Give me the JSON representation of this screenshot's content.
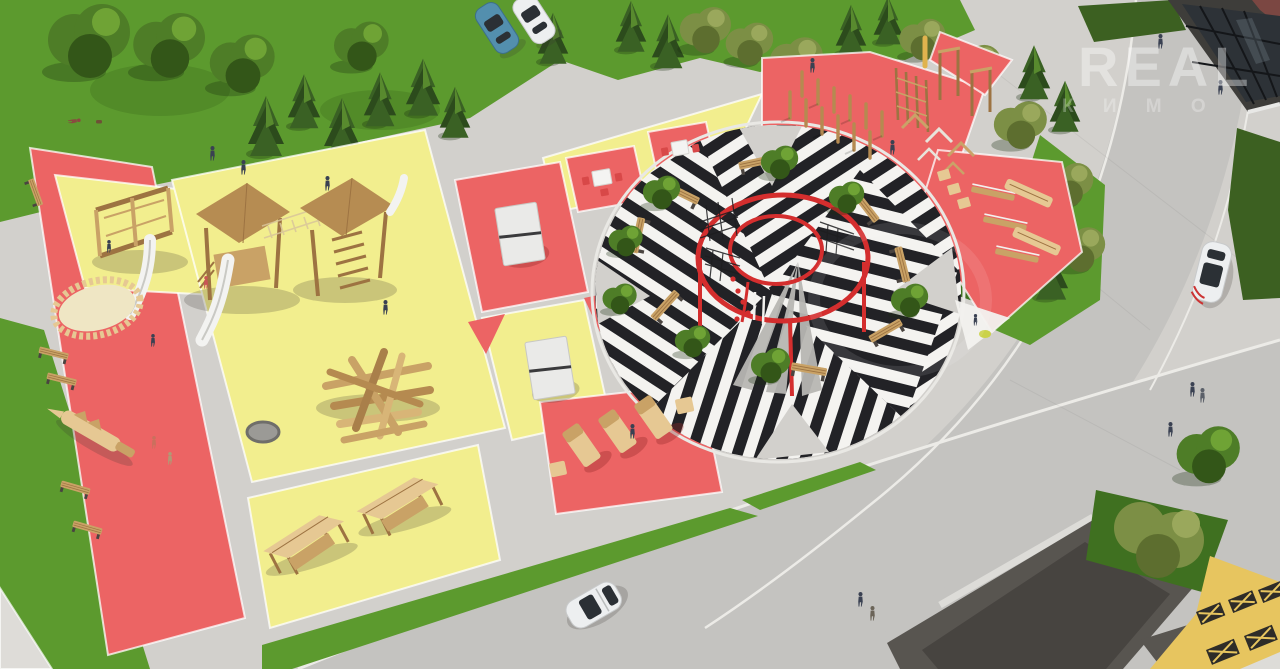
{
  "meta": {
    "type": "aerial-3d-architectural-render",
    "subject": "courtyard park masterplan with playground, striped plaza and workout zones"
  },
  "watermark": {
    "line1": "REAL",
    "line2": "К И М О",
    "has_ring": true
  },
  "palette": {
    "pavement": "#d2d0cc",
    "pad": "#dedcd8",
    "road": "#c4c3c0",
    "curb": "#ecebe7",
    "lawn": "#5c9a2e",
    "lawn_dark": "#3f7020",
    "hedge": "#3c6021",
    "conifer_dark": "#2c4b1c",
    "conifer_mid": "#3a6124",
    "conifer_hl": "#588a2e",
    "decid": "#4e7d27",
    "olive": "#7c8f45",
    "zone_red": "#ec6464",
    "zone_yellow": "#f2ee8e",
    "stripe_white": "#f4f3f0",
    "stripe_black": "#222226",
    "ring_red": "#d42e2e",
    "wood": "#c9a266",
    "wood_dark": "#9d7342",
    "wood_light": "#e6c893",
    "roof": "#b68c52",
    "sand": "#efe6c4",
    "frame": "#3e3d3a",
    "glass": "#2d3237",
    "pavilion": "#585550",
    "pavilion_dark": "#474440",
    "bldg_yellow": "#e7c55f",
    "lattice": "#2e2c28",
    "car_white": "#edeff0",
    "car_blue": "#538fae",
    "watermark": "rgba(255,255,255,0.38)"
  },
  "scene": {
    "zones": [
      {
        "name": "kids-zone-west",
        "colors": [
          "red",
          "yellow"
        ],
        "items": [
          "climbing-frame-with-slide",
          "oval-sandbox",
          "wooden-crocodile",
          "benches"
        ]
      },
      {
        "name": "playground-main",
        "color": "yellow",
        "items": [
          "play-tower-with-slide",
          "play-tower",
          "rope-bridge",
          "log-climber",
          "round-cover",
          "swing-pergolas"
        ]
      },
      {
        "name": "games-strip",
        "colors": [
          "red",
          "yellow"
        ],
        "items": [
          "table-tennis-table",
          "table-tennis-table",
          "chess-table-set",
          "chess-table-set",
          "sun-loungers",
          "cube-seats"
        ]
      },
      {
        "name": "central-plaza",
        "pattern": "black-white-striped-paving",
        "items": [
          "red-double-ring-pergola",
          "climbing-nets",
          "benches",
          "planted-trees"
        ]
      },
      {
        "name": "workout-zone-northeast",
        "color": "red",
        "items": [
          "pommel-posts",
          "wall-bars",
          "pull-up-bars",
          "rail-frames",
          "balance-beams",
          "step-boxes",
          "incline-benches"
        ]
      }
    ],
    "vehicles": [
      {
        "type": "car",
        "color": "blue",
        "location": "parking-north"
      },
      {
        "type": "car",
        "color": "white",
        "location": "parking-north"
      },
      {
        "type": "car",
        "color": "white",
        "location": "road-east"
      },
      {
        "type": "car",
        "color": "white",
        "location": "road-south"
      }
    ],
    "buildings": [
      "glass-storefront-northeast",
      "dark-pavilion-southeast",
      "yellow-lattice-building-southeast"
    ],
    "ground_art": [
      "white-triangle-marking"
    ],
    "people_count": 20,
    "trees": {
      "conifers": 17,
      "deciduous": 12,
      "hedges": 3
    }
  }
}
